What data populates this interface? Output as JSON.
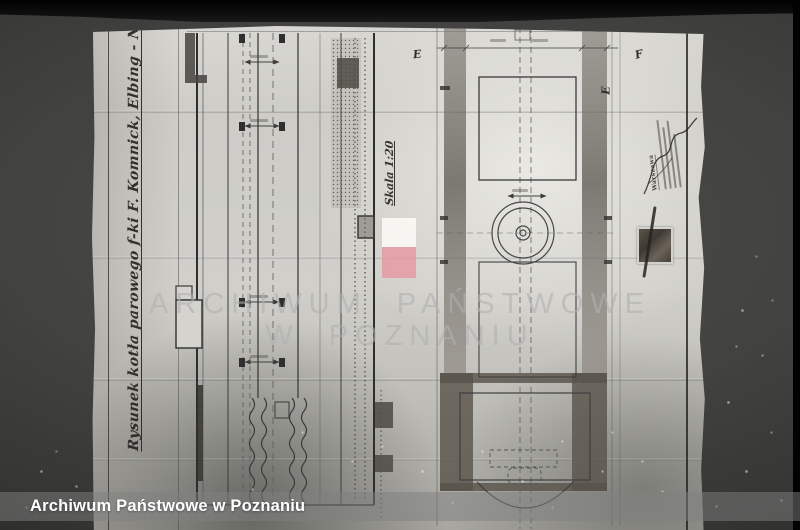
{
  "photo": {
    "type": "archival photograph of a technical drawing of a steam boiler",
    "background_color": "#3a3a38",
    "paper_color": "#cdccc7"
  },
  "drawing": {
    "title": "Rysunek kotła parowego f-ki F. Komnick, Elbing - Nr 572 - rok budowy 1",
    "scale_label": "Skala 1:20",
    "markers": {
      "e1": "E",
      "f": "F",
      "e2": "E"
    },
    "stamp_word": "Warszawa"
  },
  "watermark": {
    "line1": "ARCHIWUM PAŃSTWOWE",
    "line2": "W POZNANIU",
    "text_color": "#b0b0b0",
    "flag_white": "#faf9f5",
    "flag_red": "#e49aa3"
  },
  "caption_bar": {
    "text": "Archiwum Państwowe w Poznaniu",
    "text_color": "#ffffff"
  }
}
